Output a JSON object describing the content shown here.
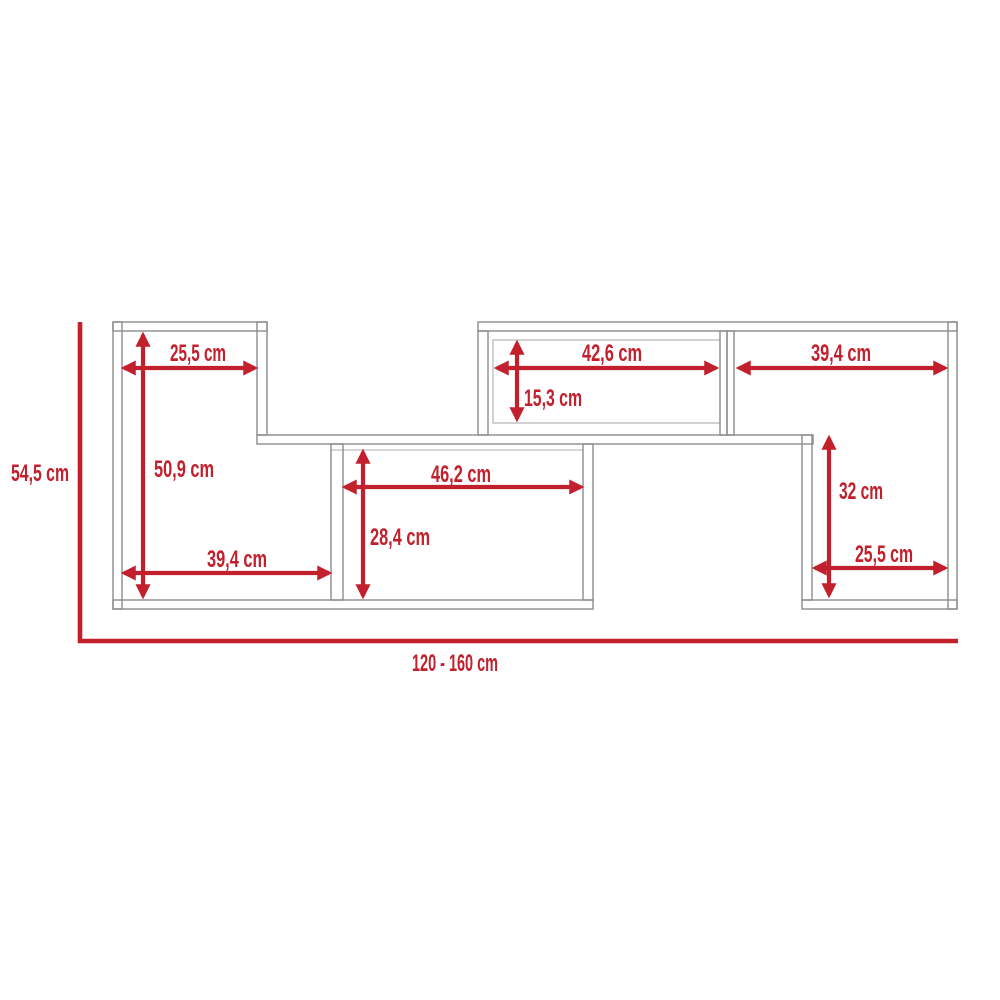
{
  "unit": "cm",
  "colors": {
    "dimension_red": "#C2202D",
    "outline_gray": "#8C8C8C",
    "outline_fine_gray": "#ADADAD",
    "background": "#FFFFFF"
  },
  "dims": {
    "top_left_width": "25,5 cm",
    "left_inner_height": "50,9 cm",
    "bottom_left_width": "39,4 cm",
    "center_width": "46,2 cm",
    "center_inner_height": "28,4 cm",
    "top_middle_width": "42,6 cm",
    "top_middle_height": "15,3 cm",
    "top_right_width": "39,4 cm",
    "right_inner_height": "32 cm",
    "bottom_right_width": "25,5 cm",
    "overall_height": "54,5 cm",
    "overall_width_range": "120 - 160 cm"
  }
}
